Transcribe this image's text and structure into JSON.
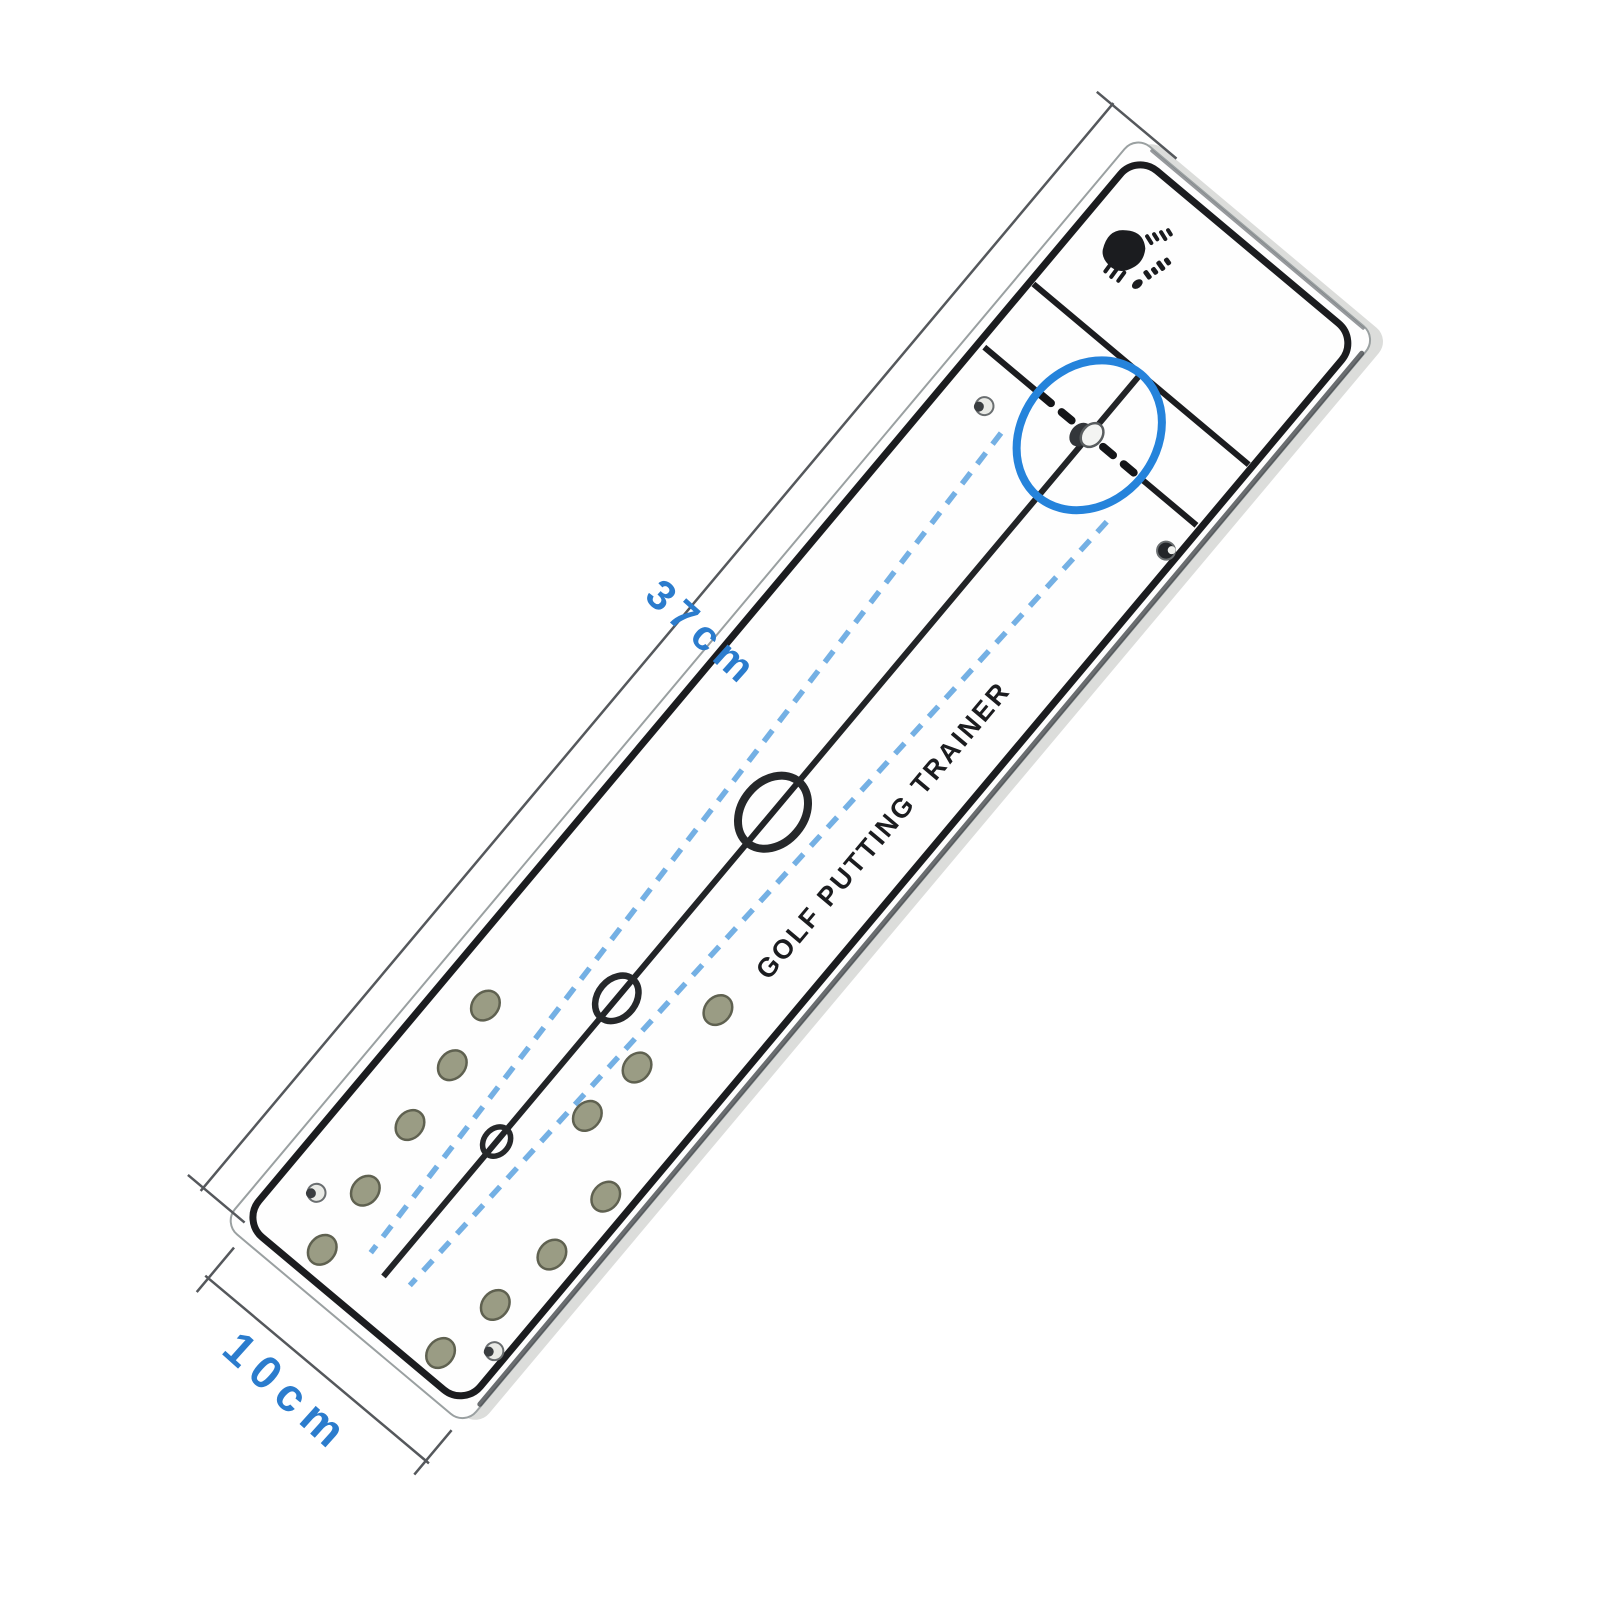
{
  "scene": {
    "description": "product photo of a golf putting alignment trainer plate shown diagonally",
    "product_label": "GOLF PUTTING TRAINER",
    "brand_logo_icon": "golfer-brand-logo-icon",
    "dimensions": {
      "length_label": "37cm",
      "width_label": "10cm"
    },
    "colors": {
      "background": "#ffffff",
      "plate_white": "#fefefe",
      "print_black": "#1b1c1f",
      "highlight_circle_blue": "#2583db",
      "guide_dash_blue": "#74b0e4",
      "dimension_text_blue": "#2b7ccd",
      "hole_dot_gray": "#9a9c84",
      "dimension_line_gray": "#55585c"
    }
  }
}
